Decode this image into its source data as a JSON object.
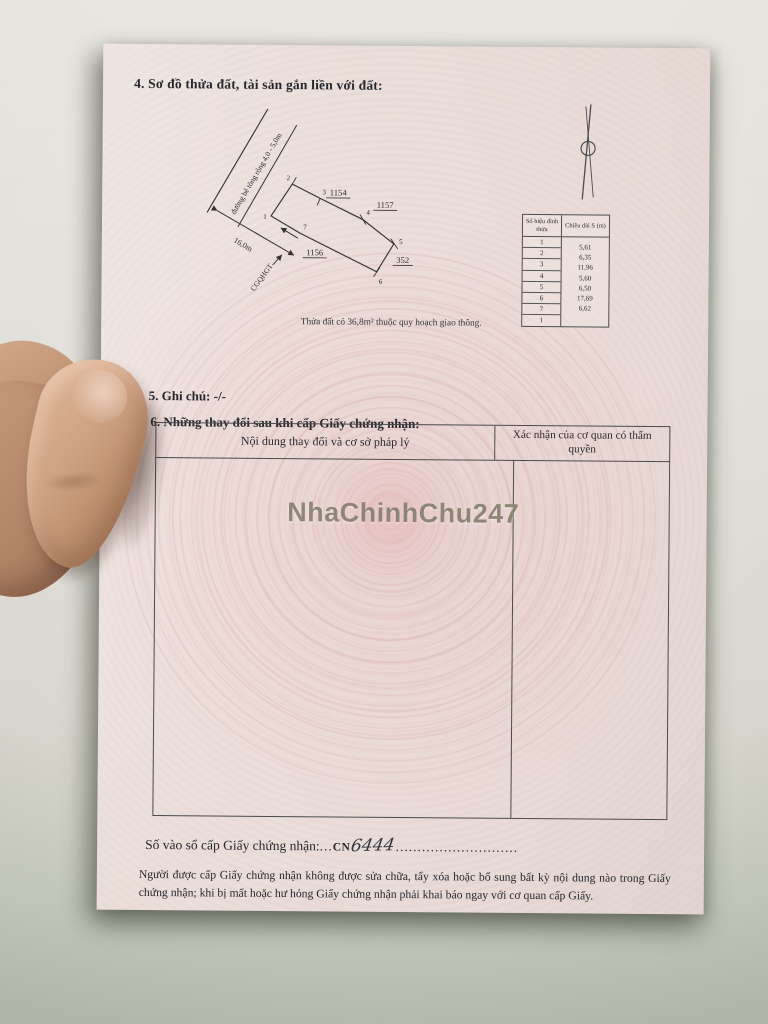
{
  "page": {
    "section4_title": "4. Sơ đồ thửa đất, tài sản gắn liền với đất:",
    "diagram": {
      "road_label": "đường bê tông rộng 4,0 - 5,0m",
      "dimension_label": "16,0m",
      "boundary_label": "CGQHGT",
      "parcel_labels": {
        "p1154": "1154",
        "p1157": "1157",
        "p1156": "1156",
        "p352": "352"
      },
      "vertex_labels": {
        "v1": "1",
        "v2": "2",
        "v3": "3",
        "v4": "4",
        "v5": "5",
        "v6": "6",
        "v7": "7"
      },
      "note": "Thửa đất có 36,8m² thuộc quy hoạch giao thông."
    },
    "vertex_table": {
      "col1_header": "Số hiệu đỉnh thửa",
      "col2_header": "Chiều dài S (m)",
      "vertices": [
        "1",
        "2",
        "3",
        "4",
        "5",
        "6",
        "7",
        "1"
      ],
      "lengths": [
        "5,61",
        "6,35",
        "11,96",
        "5,60",
        "6,50",
        "17,69",
        "6,62"
      ]
    },
    "section5": "5. Ghi chú: -/-",
    "section6_title": "6. Những thay đổi sau khi cấp Giấy chứng nhận:",
    "changes_table": {
      "col1_header": "Nội dung thay đổi và cơ sở pháp lý",
      "col2_header": "Xác nhận của cơ quan có thẩm quyền"
    },
    "watermark": "NhaChinhChu247",
    "registry_line": {
      "label": "Số vào sổ cấp Giấy chứng nhận:",
      "dots1": "...",
      "prefix": "CN",
      "number": "6444",
      "dots2": "............................"
    },
    "footer": "Người được cấp Giấy chứng nhận không được sửa chữa, tẩy xóa hoặc bổ sung bất kỳ nội dung nào trong Giấy chứng nhận; khi bị mất hoặc hư hỏng Giấy chứng nhận phải khai báo ngay với cơ quan cấp Giấy."
  }
}
